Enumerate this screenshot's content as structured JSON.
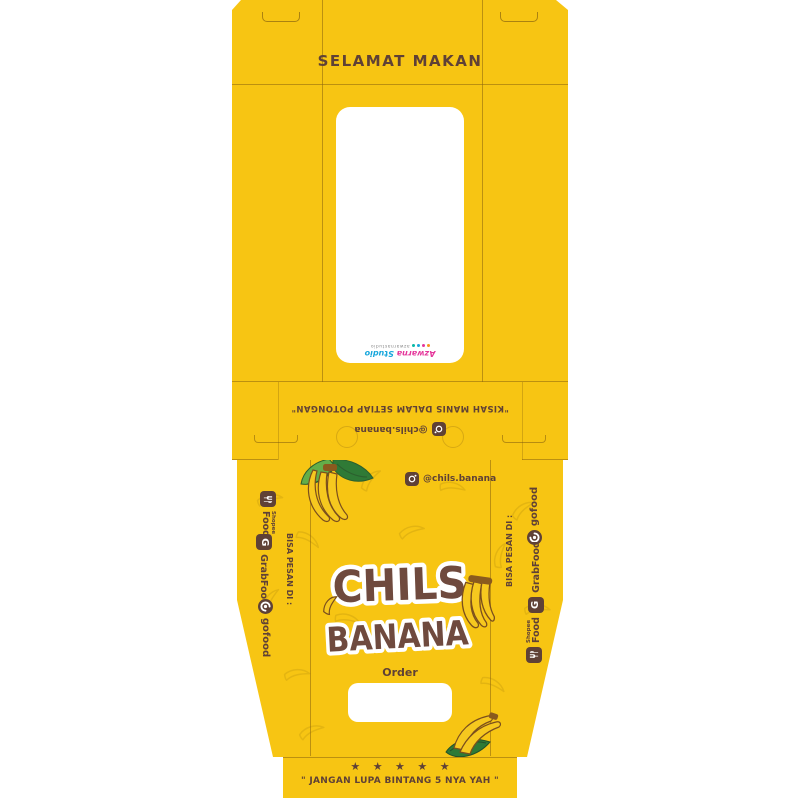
{
  "package": {
    "lid": {
      "title": "SELAMAT MAKAN"
    },
    "window_watermark": {
      "studio_name_a": "Azwarna",
      "studio_name_b": "Studio",
      "contact_line": "azwarnastudio"
    },
    "collar": {
      "tagline": "\"KISAH MANIS DALAM SETIAP POTONGAN\"",
      "instagram": "@chils.banana"
    },
    "main": {
      "instagram": "@chils.banana",
      "brand_line1": "CHILS",
      "brand_line2": "BANANA",
      "order_label": "Order",
      "side_panel_label": "BISA PESAN DI :",
      "delivery": [
        {
          "name": "ShopeeFood",
          "label_small": "Shopee",
          "label_big": "Food"
        },
        {
          "name": "GrabFood",
          "label": "GrabFood"
        },
        {
          "name": "gofood",
          "label": "gofood"
        }
      ]
    },
    "bottom": {
      "stars": "★ ★ ★ ★ ★",
      "note": "\" JANGAN LUPA BINTANG 5 NYA YAH \""
    }
  },
  "colors": {
    "yellow": "#F7C513",
    "brown": "#5F4136",
    "logo-brown": "#6F4A3E",
    "wm-pink": "#E5379B",
    "wm-blue": "#18A7DC",
    "leaf-d": "#2F7A36",
    "leaf-l": "#63AE49",
    "ban": "#F6C81F",
    "ban-o": "#7B4F1D"
  }
}
